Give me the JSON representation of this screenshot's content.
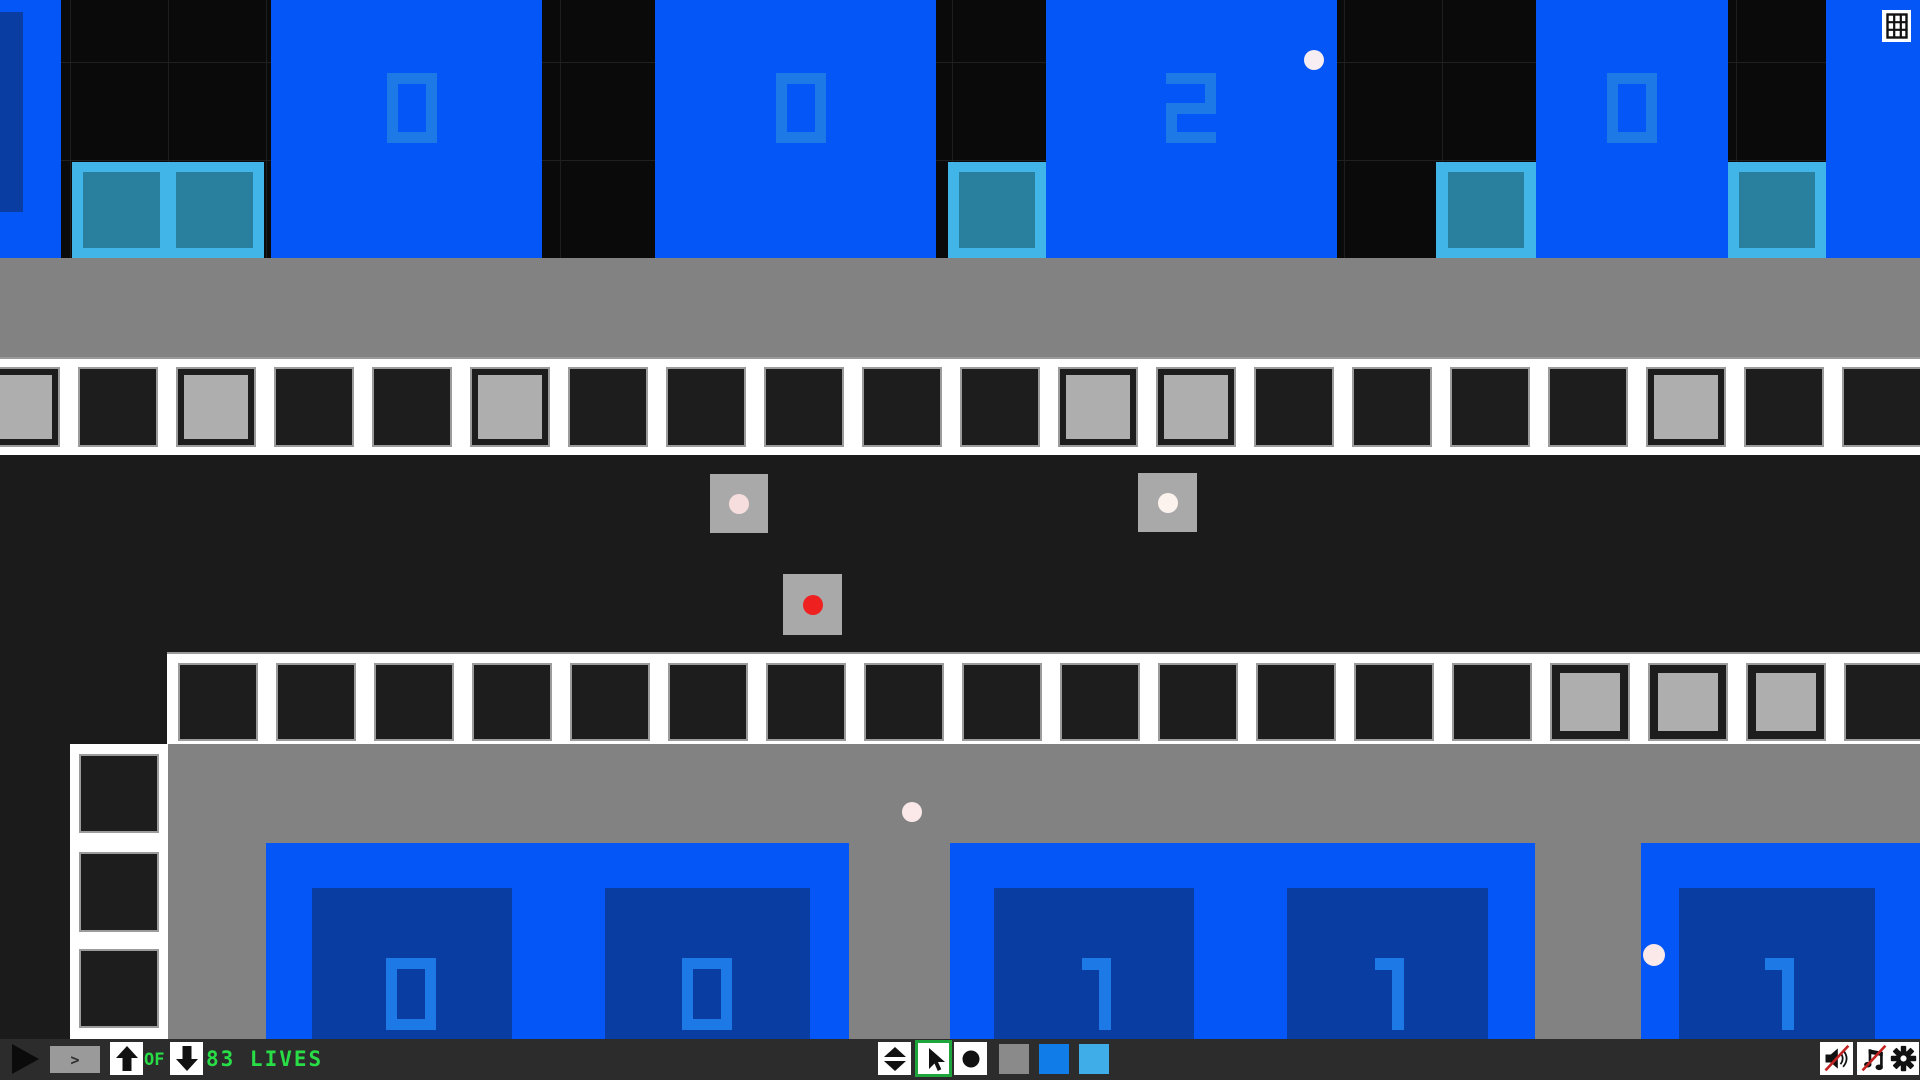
{
  "colors": {
    "bright_blue": "#0556f7",
    "dark_navy_panel": "#0a3da1",
    "digit_blue": "#1d79e6",
    "pad_light_blue": "#41b5e8",
    "pad_teal": "#28809e",
    "sky_black": "#0a0a0a",
    "ground_gray": "#828282",
    "track_white": "#ffffff",
    "track_cell_black": "#1d1d1d",
    "track_cell_gray": "#aeaeae",
    "toolbar_bg": "#2c2c2c",
    "hud_green": "#28dd46",
    "red_ball": "#ee2020",
    "selected_tool_green": "#1ea53c",
    "swatch_gray": "#8a8a8a",
    "swatch_blue": "#0f7ce8",
    "swatch_light_blue": "#3fade8"
  },
  "toolbar": {
    "step_label": ">",
    "of_label": "OF",
    "lives_label": "83 LIVES",
    "selected_tool": "cursor",
    "sound_muted": true,
    "music_muted": true
  },
  "counters": {
    "top_values": [
      "0",
      "0",
      "2",
      "0"
    ],
    "bottom_values": [
      "0",
      "0",
      "1",
      "1",
      "1"
    ]
  },
  "playfield": {
    "regions": {
      "gray_band": {
        "x": 0,
        "y": 258,
        "w": 1920,
        "h": 99
      },
      "mid_black": {
        "x": 0,
        "y": 455,
        "w": 1920,
        "h": 197
      },
      "left_black": {
        "x": 0,
        "y": 652,
        "w": 167,
        "h": 387
      },
      "bottom_gray": {
        "x": 167,
        "y": 744,
        "w": 1753,
        "h": 295
      }
    },
    "top_boxes": [
      {
        "value": null,
        "frame": {
          "x": 0,
          "y": 0,
          "w": 61,
          "h": 258
        },
        "panel": {
          "x": -30,
          "y": 12,
          "w": 53,
          "h": 200
        },
        "digit": null
      },
      {
        "value": "0",
        "frame": {
          "x": 271,
          "y": 0,
          "w": 271,
          "h": 258
        },
        "panel": {
          "x": 312,
          "y": 12,
          "w": 200,
          "h": 199
        },
        "digit": {
          "ch": "0",
          "x": 387,
          "y": 73,
          "w": 50,
          "h": 70
        }
      },
      {
        "value": "0",
        "frame": {
          "x": 655,
          "y": 0,
          "w": 281,
          "h": 258
        },
        "panel": {
          "x": 701,
          "y": 12,
          "w": 201,
          "h": 199
        },
        "digit": {
          "ch": "0",
          "x": 776,
          "y": 73,
          "w": 50,
          "h": 70
        }
      },
      {
        "value": "2",
        "frame": {
          "x": 1046,
          "y": 0,
          "w": 291,
          "h": 258
        },
        "panel": {
          "x": 1092,
          "y": 12,
          "w": 199,
          "h": 198
        },
        "digit": {
          "ch": "2",
          "x": 1166,
          "y": 73,
          "w": 50,
          "h": 70
        }
      },
      {
        "value": "0",
        "frame": {
          "x": 1536,
          "y": 0,
          "w": 192,
          "h": 258
        },
        "panel": {
          "x": 1572,
          "y": 12,
          "w": 120,
          "h": 198
        },
        "digit": {
          "ch": "0",
          "x": 1607,
          "y": 73,
          "w": 50,
          "h": 70
        }
      },
      {
        "value": null,
        "frame": {
          "x": 1826,
          "y": 0,
          "w": 94,
          "h": 258
        },
        "panel": {
          "x": 1872,
          "y": 10,
          "w": 60,
          "h": 200
        },
        "digit": null
      }
    ],
    "teal_pads": [
      {
        "x": 72,
        "y": 162,
        "w": 192,
        "h": 96,
        "squares": [
          {
            "x": 11,
            "y": 10,
            "w": 77,
            "h": 76
          },
          {
            "x": 104,
            "y": 10,
            "w": 77,
            "h": 76
          }
        ]
      },
      {
        "x": 948,
        "y": 162,
        "w": 98,
        "h": 96,
        "squares": [
          {
            "x": 11,
            "y": 10,
            "w": 76,
            "h": 76
          }
        ]
      },
      {
        "x": 1436,
        "y": 162,
        "w": 100,
        "h": 96,
        "squares": [
          {
            "x": 12,
            "y": 10,
            "w": 76,
            "h": 76
          }
        ]
      },
      {
        "x": 1728,
        "y": 162,
        "w": 98,
        "h": 96,
        "squares": [
          {
            "x": 11,
            "y": 10,
            "w": 76,
            "h": 76
          }
        ]
      }
    ],
    "track_rows": [
      {
        "x": 0,
        "y": 357,
        "w": 1920,
        "h": 98,
        "cell": {
          "start": -20,
          "pitch": 98,
          "count": 21,
          "y": 8,
          "w": 80,
          "h": 80,
          "inset": 8
        },
        "gray_cells": [
          0,
          2,
          5,
          11,
          12,
          17
        ]
      },
      {
        "x": 167,
        "y": 652,
        "w": 1753,
        "h": 92,
        "cell": {
          "start": 11,
          "pitch": 98,
          "count": 18,
          "y": 9,
          "w": 80,
          "h": 78,
          "inset": 10
        },
        "gray_cells": [
          14,
          15,
          16
        ]
      }
    ],
    "ladder": {
      "x": 70,
      "y": 744,
      "w": 98,
      "h": 295,
      "cells": [
        {
          "x": 9,
          "y": 10,
          "w": 80,
          "h": 79
        },
        {
          "x": 9,
          "y": 108,
          "w": 80,
          "h": 80
        },
        {
          "x": 9,
          "y": 205,
          "w": 80,
          "h": 79
        }
      ]
    },
    "dot_tiles": [
      {
        "x": 710,
        "y": 474,
        "w": 58,
        "h": 59,
        "dot_color": "#f6dede",
        "dot_r": 10
      },
      {
        "x": 1138,
        "y": 473,
        "w": 59,
        "h": 59,
        "dot_color": "#fdf3ee",
        "dot_r": 10
      },
      {
        "x": 783,
        "y": 574,
        "w": 59,
        "h": 61,
        "dot_color": "#ee2020",
        "dot_r": 10
      }
    ],
    "balls": [
      {
        "cx": 1314,
        "cy": 60,
        "r": 10,
        "color": "#f6eef2"
      },
      {
        "cx": 912,
        "cy": 812,
        "r": 10,
        "color": "#fbe9e9"
      },
      {
        "cx": 1654,
        "cy": 955,
        "r": 11,
        "color": "#fbe8e8"
      }
    ],
    "bottom_boxes": [
      {
        "frame": {
          "x": 266,
          "y": 843,
          "w": 583,
          "h": 196
        },
        "panels": [
          {
            "x": 46,
            "y": 45,
            "w": 200,
            "h": 151,
            "value": "0",
            "digit": {
              "ch": "0",
              "x": 386,
              "y": 958,
              "w": 50,
              "h": 72
            }
          },
          {
            "x": 339,
            "y": 45,
            "w": 205,
            "h": 151,
            "value": "0",
            "digit": {
              "ch": "0",
              "x": 682,
              "y": 958,
              "w": 50,
              "h": 72
            }
          }
        ]
      },
      {
        "frame": {
          "x": 950,
          "y": 843,
          "w": 585,
          "h": 196
        },
        "panels": [
          {
            "x": 44,
            "y": 45,
            "w": 200,
            "h": 151,
            "value": "1",
            "digit": {
              "ch": "1",
              "x": 1077,
              "y": 958,
              "w": 34,
              "h": 72
            }
          },
          {
            "x": 337,
            "y": 45,
            "w": 201,
            "h": 151,
            "value": "1",
            "digit": {
              "ch": "1",
              "x": 1370,
              "y": 958,
              "w": 34,
              "h": 72
            }
          }
        ]
      },
      {
        "frame": {
          "x": 1641,
          "y": 843,
          "w": 290,
          "h": 196
        },
        "panels": [
          {
            "x": 38,
            "y": 45,
            "w": 196,
            "h": 151,
            "value": "1",
            "digit": {
              "ch": "1",
              "x": 1760,
              "y": 958,
              "w": 34,
              "h": 72
            }
          }
        ]
      }
    ]
  }
}
